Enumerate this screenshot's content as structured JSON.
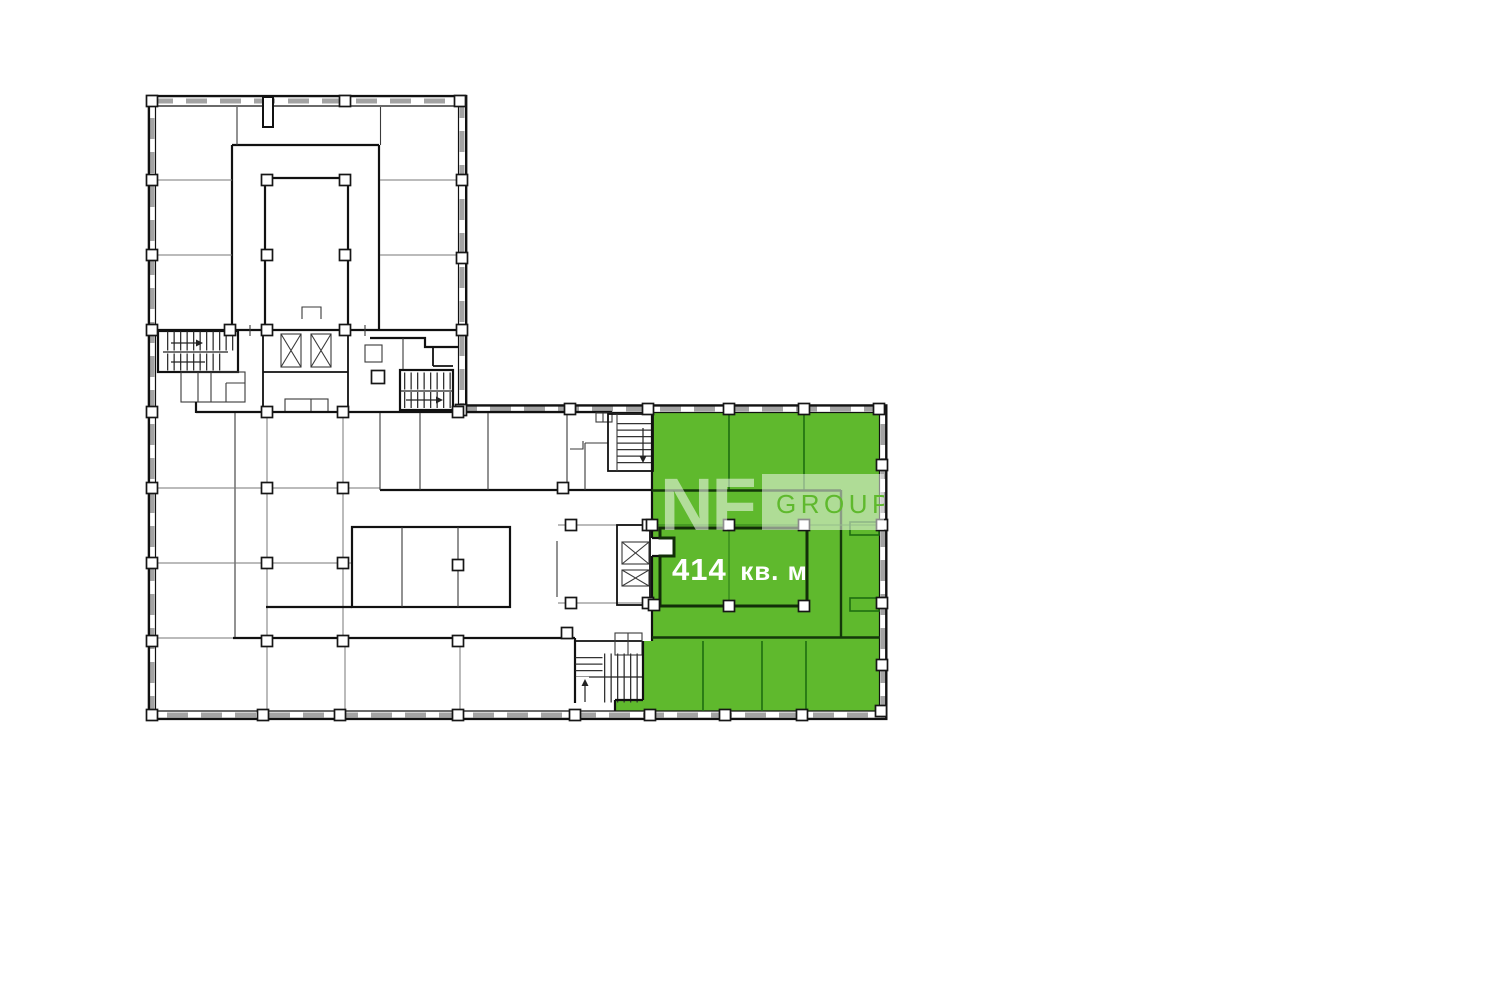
{
  "plan": {
    "area_value": "414",
    "area_unit": "кв. м",
    "area_label": "414 кв. м",
    "highlight_color": "#5fb92d",
    "wall_color": "#111111",
    "window_color": "#a3a3a3"
  },
  "watermark": {
    "name": "NF",
    "suffix": "GROUP",
    "band_opacity": "0.5"
  }
}
